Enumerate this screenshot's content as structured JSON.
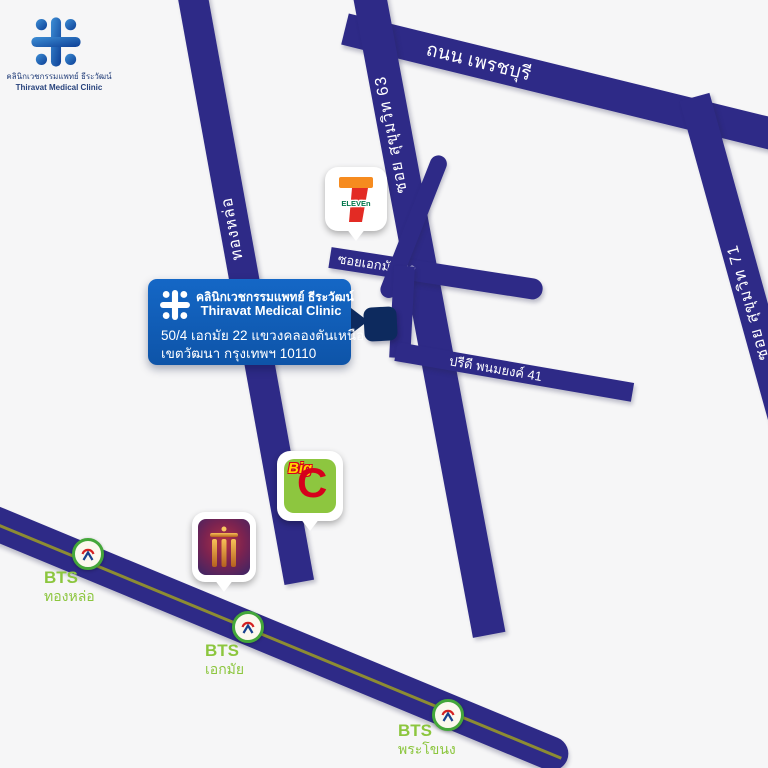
{
  "header": {
    "clinic_th": "คลินิกเวชกรรมแพทย์ ธีระวัฒน์",
    "clinic_en": "Thiravat Medical Clinic"
  },
  "callout": {
    "clinic_th": "คลินิกเวชกรรมแพทย์ ธีระวัฒน์",
    "clinic_en": "Thiravat Medical Clinic",
    "address1": "50/4 เอกมัย 22 แขวงคลองตันเหนือ",
    "address2": "เขตวัฒนา กรุงเทพฯ 10110"
  },
  "roads": {
    "phetchaburi": {
      "label": "ถนน เพรชบุรี"
    },
    "sukhumvit63": {
      "label": "ซอย สุขุมวิท 63"
    },
    "thonglor": {
      "label": "ทองหล่อ"
    },
    "sukhumvit71": {
      "label": "ซอย สุขุมวิท 71"
    },
    "ekkamai22": {
      "label": "ซอยเอกมัย 22"
    },
    "pridi41": {
      "label": "ปรีดี พนมยงค์ 41"
    }
  },
  "stations": [
    {
      "brand": "BTS",
      "name_th": "ทองหล่อ"
    },
    {
      "brand": "BTS",
      "name_th": "เอกมัย"
    },
    {
      "brand": "BTS",
      "name_th": "พระโขนง"
    }
  ],
  "pois": {
    "seven_eleven": {
      "numeral": "7",
      "wordmark": "ELEVEn"
    },
    "big_c": {
      "word": "Big",
      "letter": "C"
    }
  },
  "colors": {
    "road": "#2e2a87",
    "marker_navy": "#0d2a5e",
    "callout_blue": "#1467c6",
    "bts_green": "#8cc63e",
    "bts_line_olive": "#8d8c33",
    "seven_orange": "#f68b1f",
    "seven_red": "#e32b24",
    "seven_green": "#00754a",
    "bigc_green": "#8dc63f",
    "bigc_red": "#d6001c",
    "bigc_yellow": "#ffd400"
  }
}
